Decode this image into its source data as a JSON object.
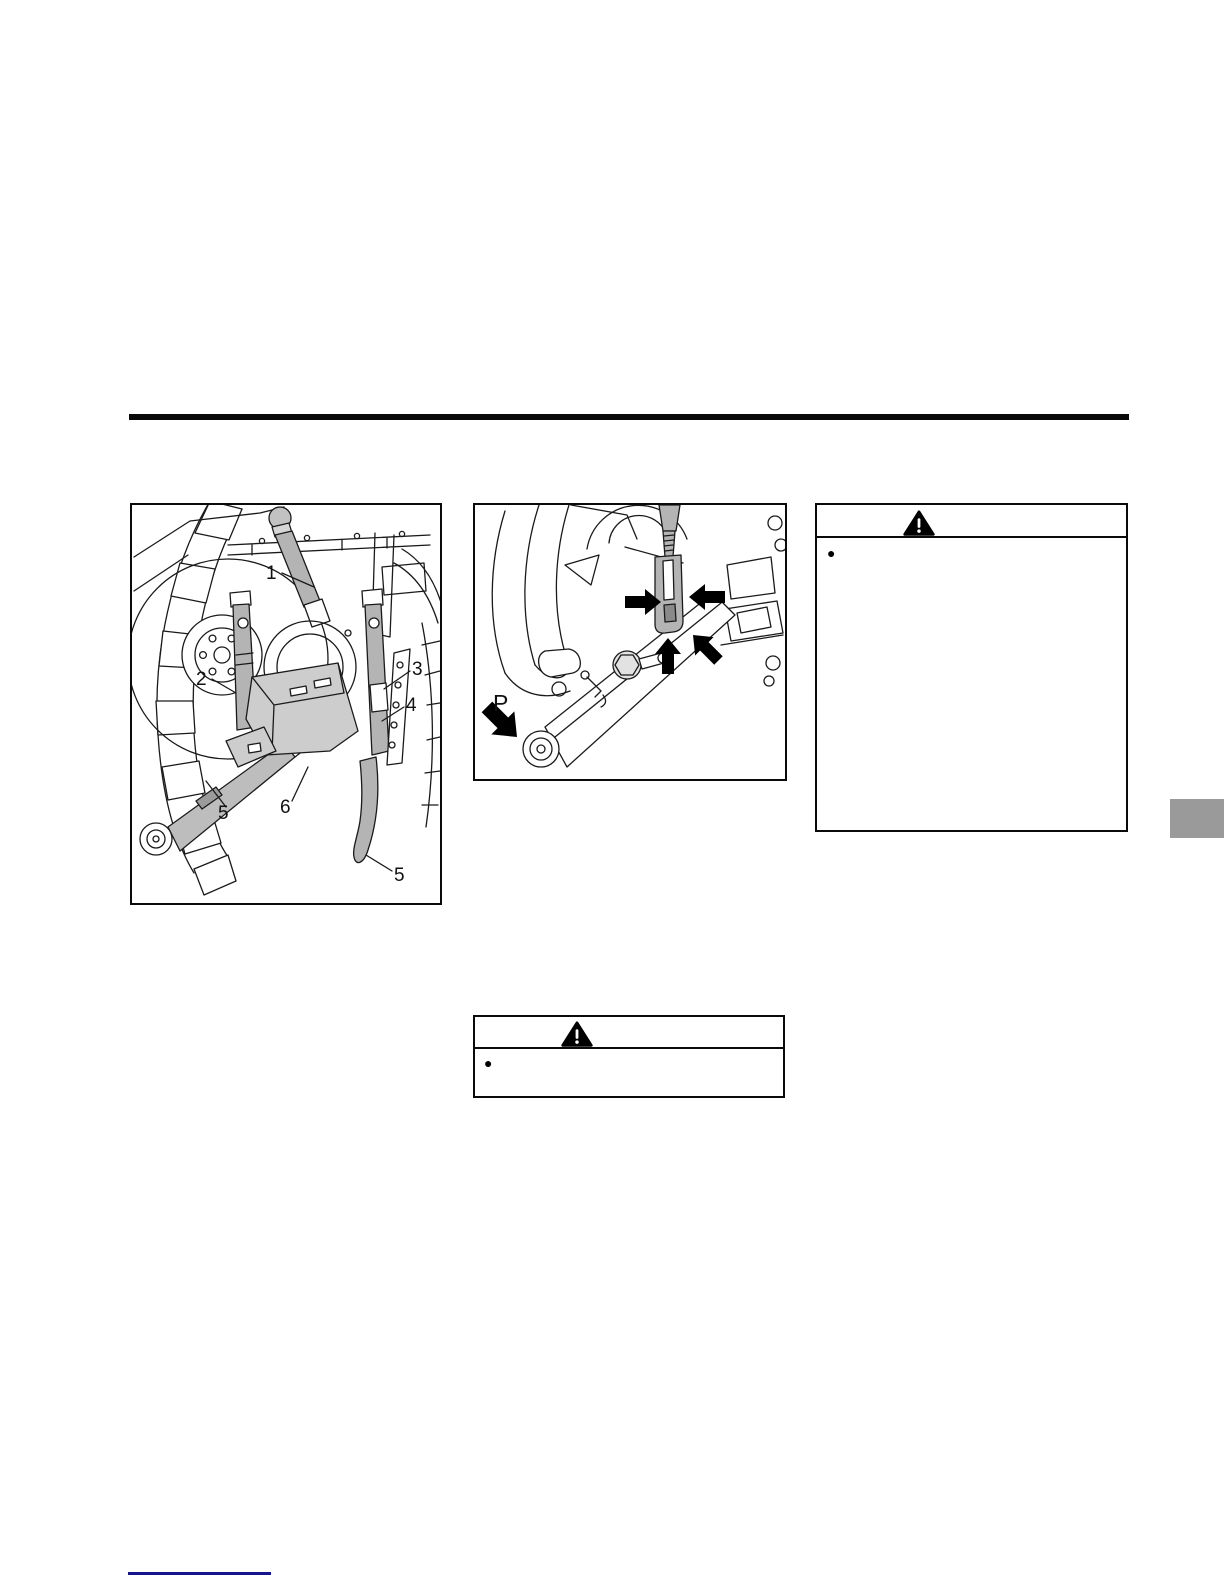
{
  "page": {
    "background_color": "#ffffff"
  },
  "top_rule": {
    "color": "#0a0a0a"
  },
  "figure_overview": {
    "description": "three-point-hitch-rear-view",
    "callouts": [
      {
        "label": "1"
      },
      {
        "label": "2"
      },
      {
        "label": "3"
      },
      {
        "label": "4"
      },
      {
        "label": "5"
      },
      {
        "label": "6"
      },
      {
        "label": "5"
      }
    ]
  },
  "figure_closeup": {
    "description": "lower-link-and-lift-rod-closeup",
    "point_label": "P"
  },
  "warning_right": {
    "icon": "warning-triangle",
    "bullet_marker": "●"
  },
  "warning_middle": {
    "icon": "warning-triangle",
    "bullet_marker": "●"
  },
  "side_tab": {
    "color": "#9a9a9a"
  },
  "footer": {
    "underline_color": "#15158d"
  }
}
